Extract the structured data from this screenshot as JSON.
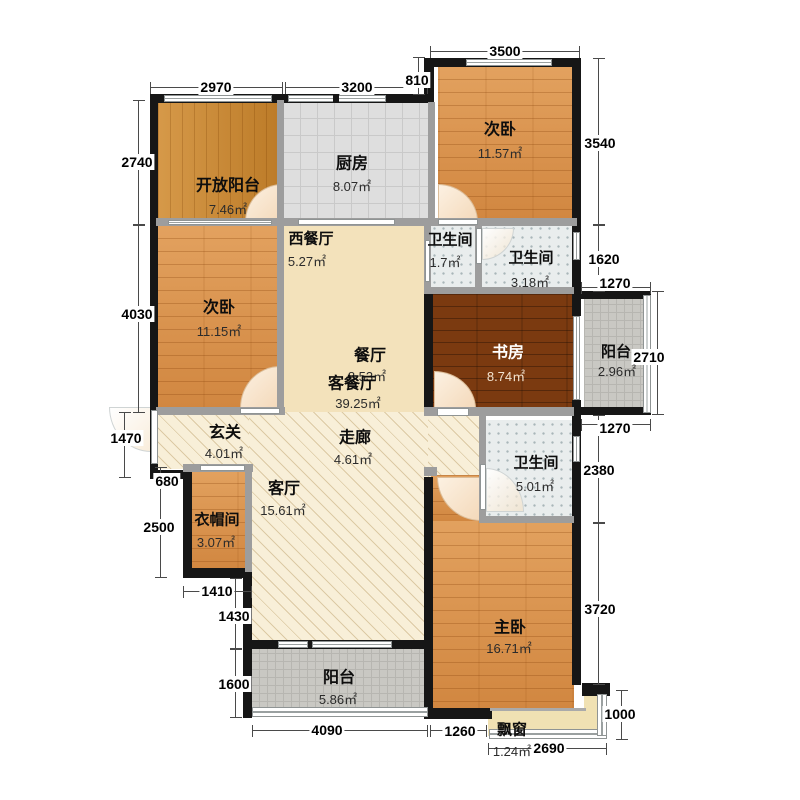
{
  "plan": {
    "type": "apartment-floor-plan",
    "rooms": [
      {
        "id": "open-balcony",
        "name": "开放阳台",
        "area": "7.46㎡"
      },
      {
        "id": "kitchen",
        "name": "厨房",
        "area": "8.07㎡"
      },
      {
        "id": "bedroom-top",
        "name": "次卧",
        "area": "11.57㎡"
      },
      {
        "id": "bath-small",
        "name": "卫生间",
        "area": "1.7㎡"
      },
      {
        "id": "bath-mid",
        "name": "卫生间",
        "area": "3.18㎡"
      },
      {
        "id": "west-dining",
        "name": "西餐厅",
        "area": "5.27㎡"
      },
      {
        "id": "bedroom-left",
        "name": "次卧",
        "area": "11.15㎡"
      },
      {
        "id": "dining",
        "name": "餐厅",
        "area": "8.53㎡"
      },
      {
        "id": "living-dining",
        "name": "客餐厅",
        "area": "39.25㎡"
      },
      {
        "id": "study",
        "name": "书房",
        "area": "8.74㎡"
      },
      {
        "id": "balcony-right",
        "name": "阳台",
        "area": "2.96㎡"
      },
      {
        "id": "foyer",
        "name": "玄关",
        "area": "4.01㎡"
      },
      {
        "id": "corridor",
        "name": "走廊",
        "area": "4.61㎡"
      },
      {
        "id": "bath-large",
        "name": "卫生间",
        "area": "5.01㎡"
      },
      {
        "id": "living",
        "name": "客厅",
        "area": "15.61㎡"
      },
      {
        "id": "cloakroom",
        "name": "衣帽间",
        "area": "3.07㎡"
      },
      {
        "id": "master-bedroom",
        "name": "主卧",
        "area": "16.71㎡"
      },
      {
        "id": "balcony-bottom",
        "name": "阳台",
        "area": "5.86㎡"
      },
      {
        "id": "bay-window",
        "name": "飘窗",
        "area": "1.24㎡"
      }
    ],
    "dimensions": {
      "top": [
        "2970",
        "3200",
        "3500",
        "810"
      ],
      "left": [
        "2740",
        "4030",
        "1470",
        "680",
        "2500",
        "1410",
        "1430",
        "1600"
      ],
      "right": [
        "3540",
        "1620",
        "1270",
        "2710",
        "1270",
        "2380",
        "3720",
        "1000"
      ],
      "bottom": [
        "4090",
        "1260",
        "2690"
      ]
    },
    "colors": {
      "wood_light": "#d98e46",
      "wood_dark": "#7b3a10",
      "open_balcony_wood": "#c8862f",
      "kitchen_tile": "#dedede",
      "bath_tile": "#e9eded",
      "balcony_tile": "#c9c8c3",
      "living_cream": "#f3e2bb",
      "hall_hatch": "#f8efd8",
      "bay_cream": "#f0e1b3",
      "wall_black": "#161616",
      "wall_gray": "#9d9d9d"
    }
  }
}
